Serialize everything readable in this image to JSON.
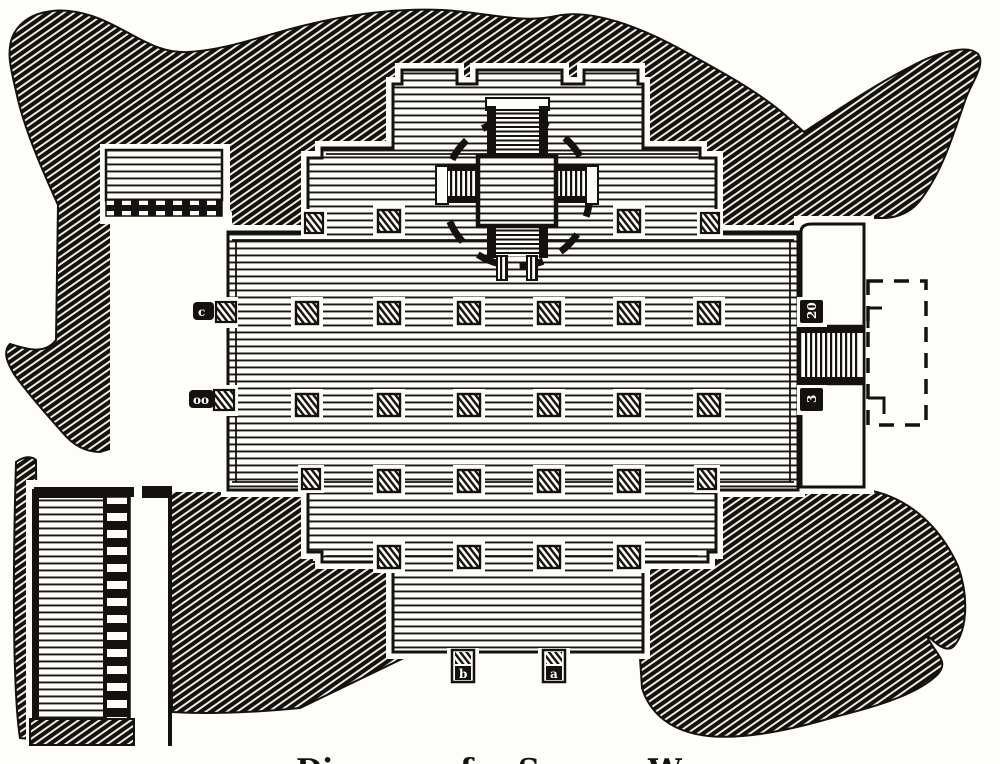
{
  "figure": {
    "kind": "engraved-temple-floor-plan",
    "paper_color": "#fdfdfa",
    "ink_color": "#15120f",
    "caption": {
      "fragments": [
        {
          "text": "Di"
        },
        {
          "text": "of"
        },
        {
          "text": "S"
        },
        {
          "text": "W"
        }
      ]
    },
    "labels": {
      "pilaster_left_upper": "c",
      "pilaster_left_lower": "oo",
      "pilaster_right_upper": "20",
      "pilaster_right_lower": "3",
      "pilaster_bottom_left": "b",
      "pilaster_bottom_right": "a"
    }
  }
}
